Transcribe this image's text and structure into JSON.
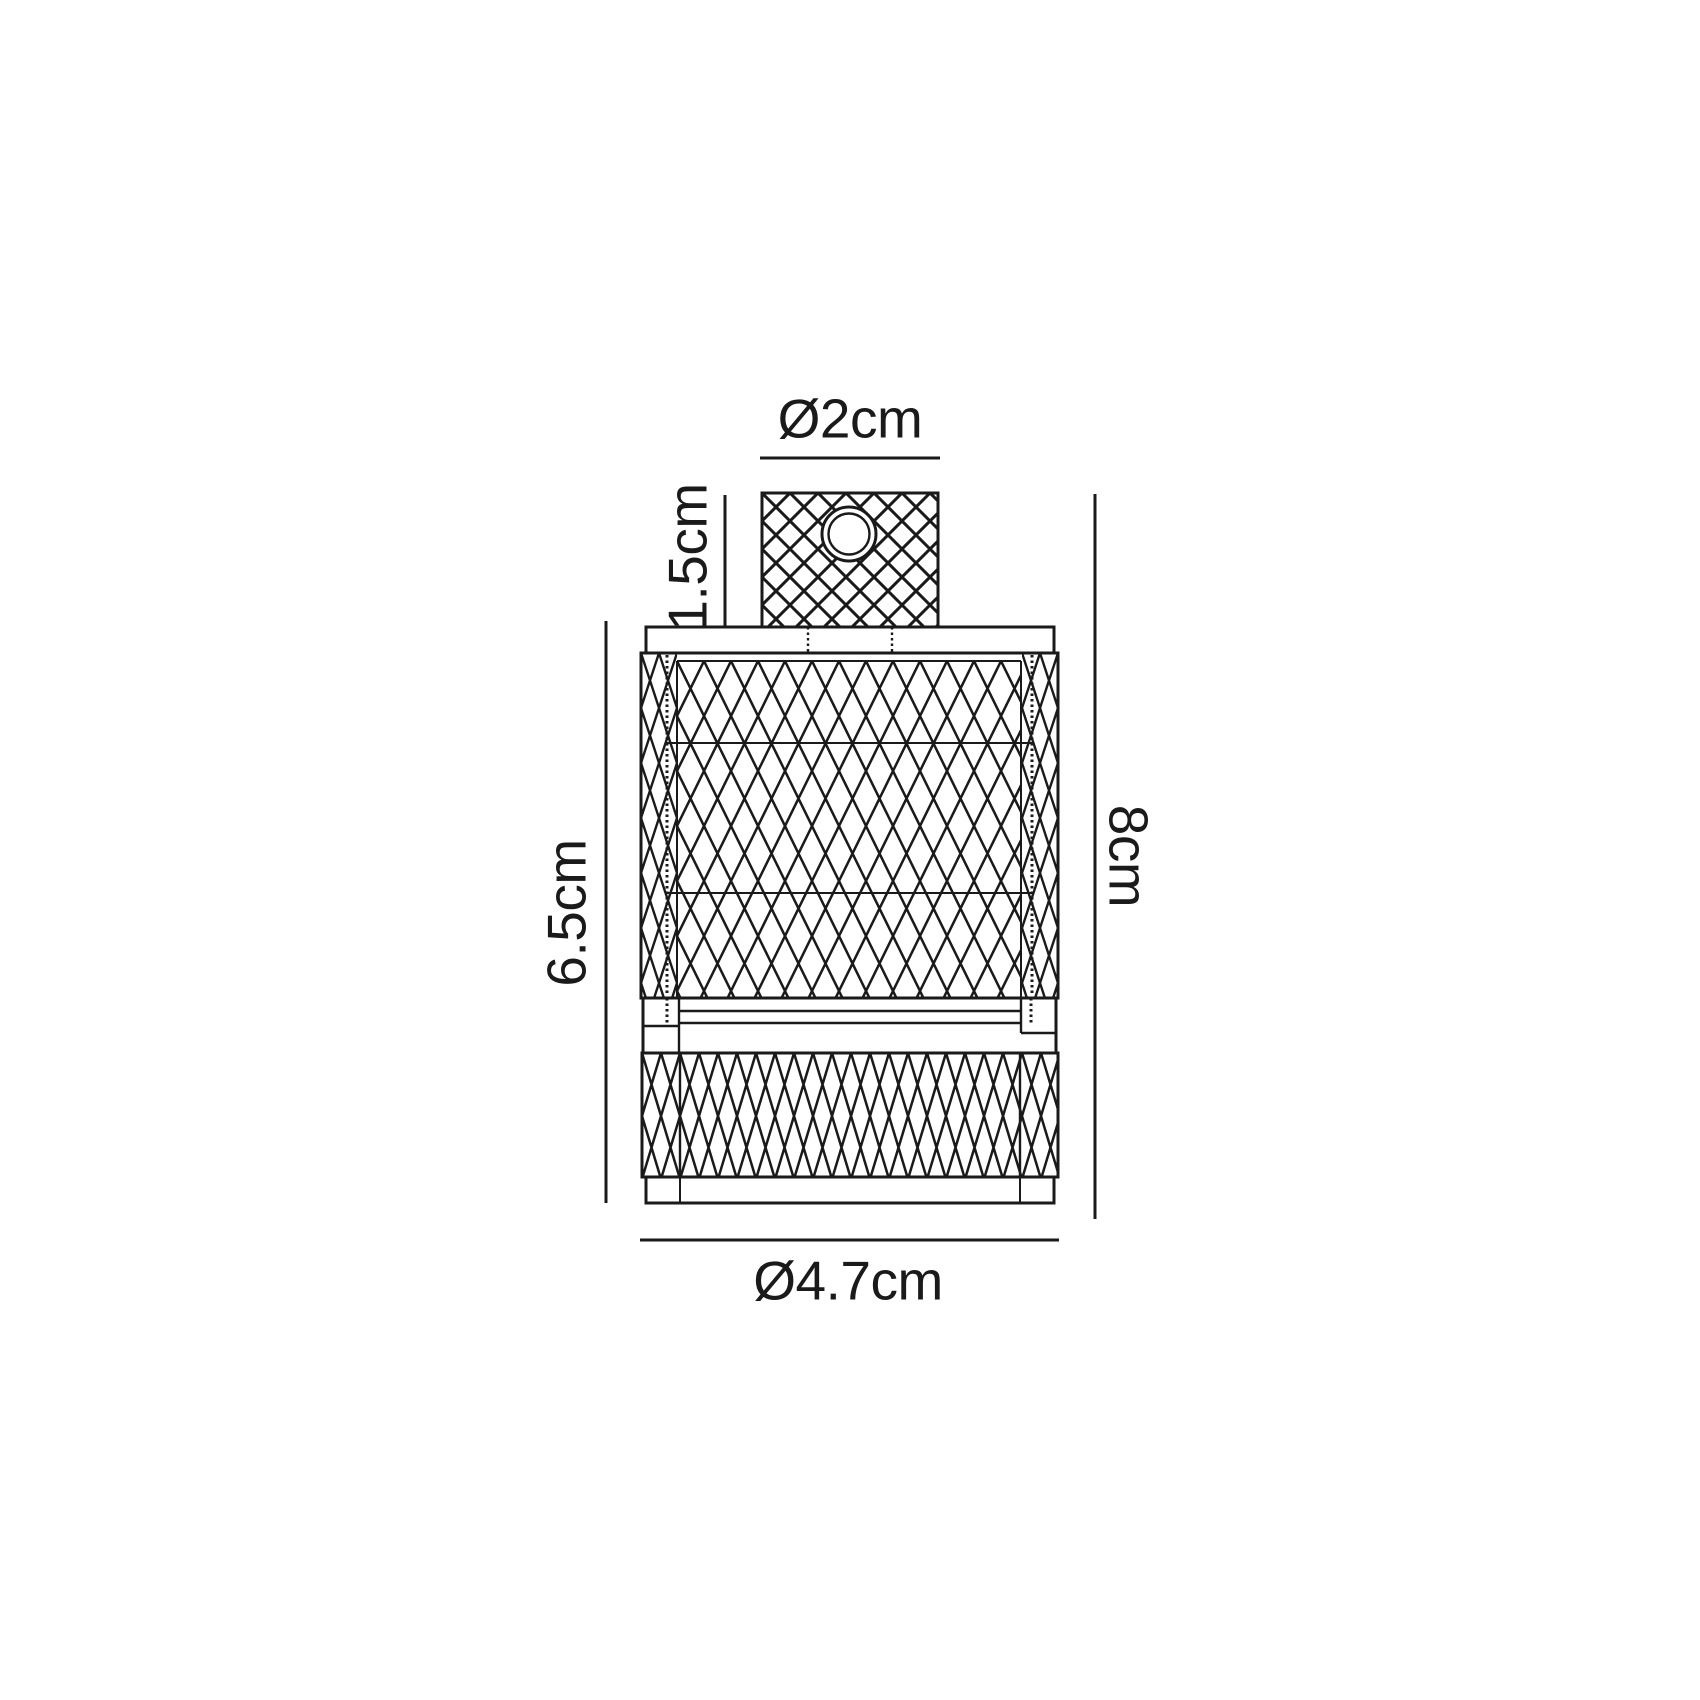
{
  "canvas": {
    "background": "#ffffff",
    "ink": "#1a1a1a"
  },
  "dimensions": {
    "top_diameter": "Ø2cm",
    "grip_height": "1.5cm",
    "body_height": "6.5cm",
    "overall_height": "8cm",
    "body_diameter": "Ø4.7cm"
  }
}
